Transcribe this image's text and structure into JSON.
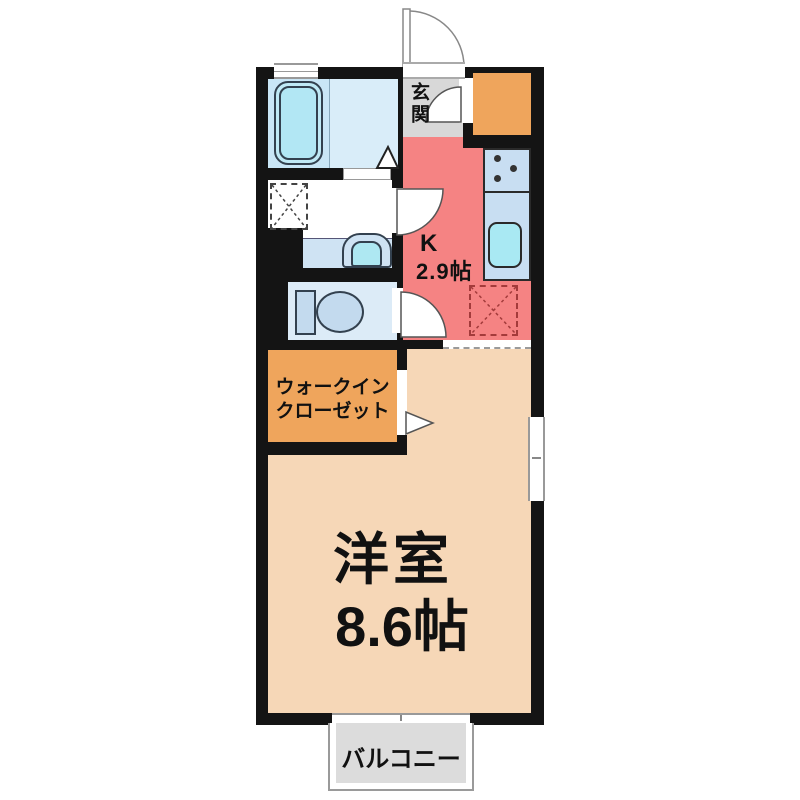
{
  "title": "apartment floor plan",
  "rooms": {
    "genkan": {
      "label": "玄関"
    },
    "kitchen": {
      "label": "K",
      "size": "2.9帖"
    },
    "walk_in_closet": {
      "label_line1": "ウォークイン",
      "label_line2": "クローゼット"
    },
    "main_room": {
      "label": "洋室",
      "size": "8.6帖"
    },
    "balcony": {
      "label": "バルコニー"
    }
  },
  "fixtures": [
    "bathtub",
    "washing-machine-space",
    "washbasin",
    "toilet",
    "stove-burners",
    "kitchen-sink",
    "refrigerator-space",
    "shoe-cabinet",
    "entrance-door",
    "bathroom-door",
    "washroom-door",
    "toilet-door",
    "closet-door-arrow",
    "windows"
  ],
  "colors": {
    "wall": "#141414",
    "kitchen_floor": "#f58383",
    "main_room_floor": "#f6d7b7",
    "closet_orange": "#efa55c",
    "bathroom_floor": "#d9edf9",
    "water_fixture": "#aee8f2",
    "genkan_gray": "#d8d8d8",
    "balcony_gray": "#dcdcdc",
    "fridge_dash": "#a33b3b"
  }
}
